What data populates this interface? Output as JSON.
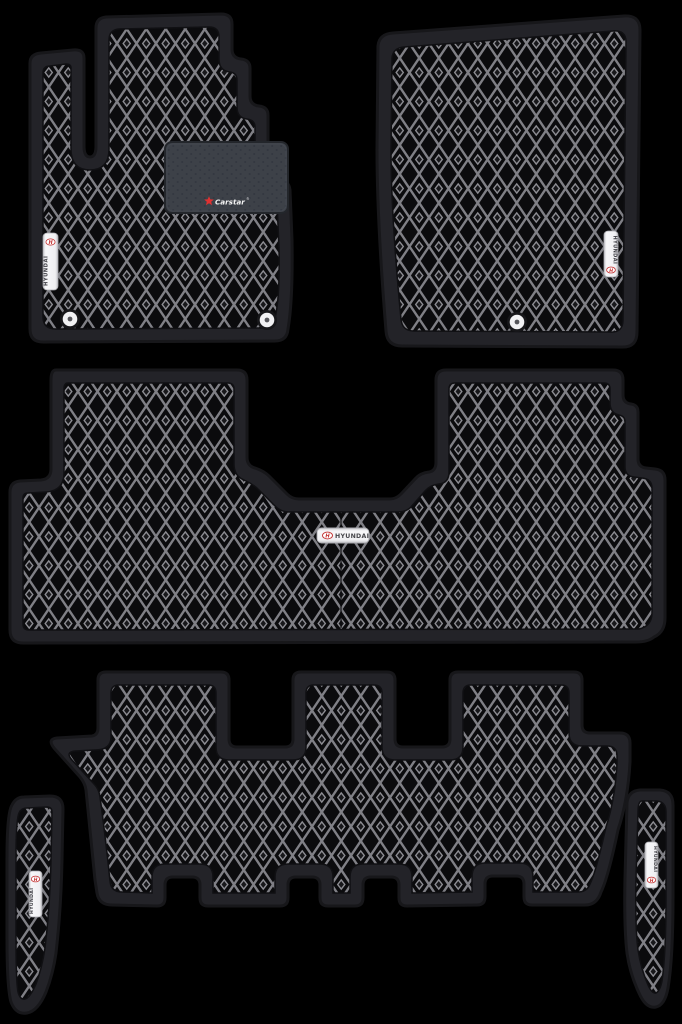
{
  "image": {
    "type": "product-photo",
    "subject": "6-piece EVA diamond-pattern car floor mat set on black background",
    "background_color": "#000000"
  },
  "branding": {
    "hyundai_label": "HYUNDAI",
    "hyundai_logo_letter": "H",
    "carstar_text": "Carstar",
    "registered_mark": "®"
  },
  "colors": {
    "mat_border": "#232328",
    "mat_outer_edge": "#17171a",
    "mat_surface": "#0b0b0d",
    "pattern_line": "#84848a",
    "heel_pad": "#3d4148",
    "label_silver": "#f2f2f4",
    "hyundai_red": "#c22f2f",
    "label_text": "#3f3f45",
    "carstar_star": "#e03131",
    "carstar_text_color": "#f5f5f5"
  },
  "mats": [
    {
      "id": "driver-front",
      "badge": "HYUNDAI",
      "heel_pad_logo": "Carstar",
      "grommet_count": 2
    },
    {
      "id": "passenger-front",
      "badge": "HYUNDAI",
      "grommet_count": 1
    },
    {
      "id": "second-row",
      "badge": "HYUNDAI"
    },
    {
      "id": "third-row"
    },
    {
      "id": "left-rear-side",
      "badge": "HYUNDAI"
    },
    {
      "id": "right-rear-side",
      "badge": "HYUNDAI"
    }
  ]
}
